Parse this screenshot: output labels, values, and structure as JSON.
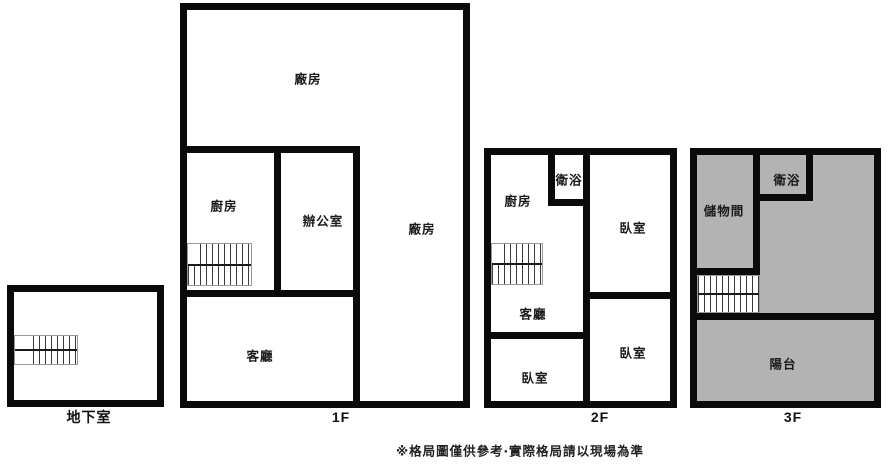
{
  "colors": {
    "wall": "#0a0a0a",
    "fill_gray": "#b3b3b3",
    "background": "#ffffff"
  },
  "floors": {
    "basement": {
      "label": "地下室"
    },
    "f1": {
      "label": "1F",
      "rooms": {
        "factory_top": "廠房",
        "kitchen": "廚房",
        "office": "辦公室",
        "factory_right": "廠房",
        "living_room": "客廳"
      }
    },
    "f2": {
      "label": "2F",
      "rooms": {
        "kitchen": "廚房",
        "bathroom": "衛浴",
        "bedroom_top_right": "臥室",
        "living_room": "客廳",
        "bedroom_bottom_left": "臥室",
        "bedroom_bottom_right": "臥室"
      }
    },
    "f3": {
      "label": "3F",
      "rooms": {
        "storage": "儲物間",
        "bathroom": "衛浴",
        "balcony": "陽台"
      }
    }
  },
  "footer": {
    "disclaimer": "※格局圖僅供參考‧實際格局請以現場為準"
  }
}
